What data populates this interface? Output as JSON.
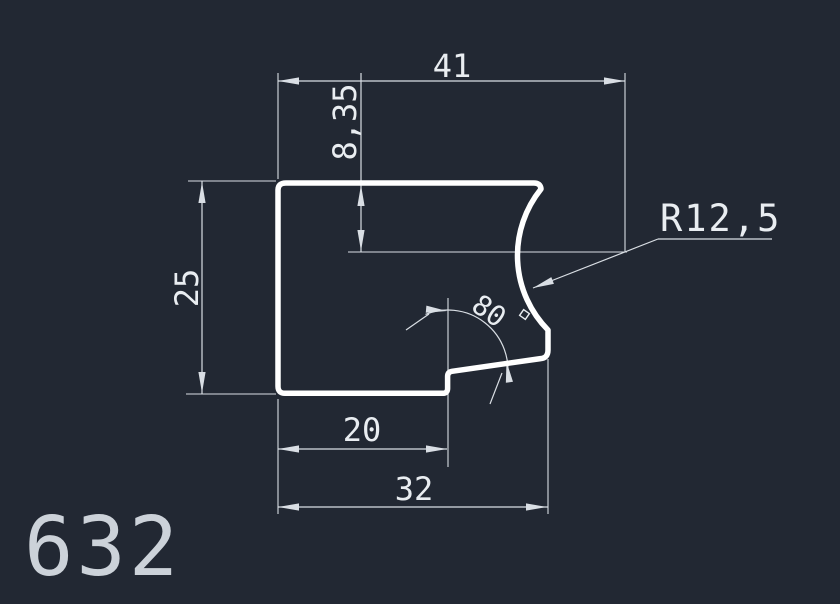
{
  "drawing": {
    "part_number": "632",
    "dimensions": {
      "total_width": "41",
      "arc_center_offset": "8,35",
      "height": "25",
      "step_width": "20",
      "bottom_width": "32",
      "radius": "R12,5",
      "angle_value": "80",
      "angle_unit": "°"
    },
    "colors": {
      "background": "#222833",
      "outline": "#ffffff",
      "dimension_lines": "#d9dee4",
      "dimension_text": "#e9edf1",
      "part_label": "#ccd2d9"
    }
  }
}
